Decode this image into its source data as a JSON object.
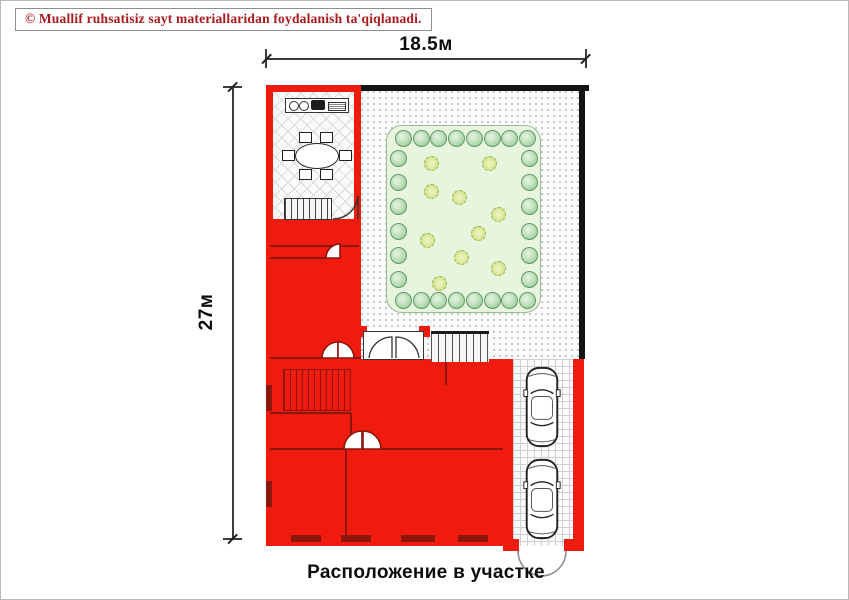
{
  "copyright_notice": "© Muallif ruhsatisiz sayt materiallaridan foydalanish ta'qiqlanadi.",
  "dimensions": {
    "top_width_label": "18.5м",
    "left_height_label": "27м"
  },
  "caption": "Расположение в участке",
  "plan": {
    "colors": {
      "building_red": "#ee1b0e",
      "wall_line": "#8d150a",
      "boundary_black": "#141414",
      "garden_fill": "#e7f4de",
      "tree_green": "#b7dcb3",
      "shrub_green": "#d3e392"
    },
    "garden": {
      "tree_icon": "border-tree",
      "shrub_icon": "garden-shrub",
      "tree_size": 17,
      "shrub_size": 15,
      "ring": {
        "top": 8,
        "bottom": 8,
        "left": 6,
        "right": 6
      },
      "shrubs": [
        [
          0.29,
          0.2
        ],
        [
          0.66,
          0.2
        ],
        [
          0.29,
          0.35
        ],
        [
          0.47,
          0.38
        ],
        [
          0.72,
          0.47
        ],
        [
          0.59,
          0.57
        ],
        [
          0.26,
          0.61
        ],
        [
          0.48,
          0.7
        ],
        [
          0.72,
          0.76
        ],
        [
          0.34,
          0.84
        ]
      ]
    },
    "parking": {
      "car_icon": "car-top-view",
      "car_count": 2
    }
  }
}
